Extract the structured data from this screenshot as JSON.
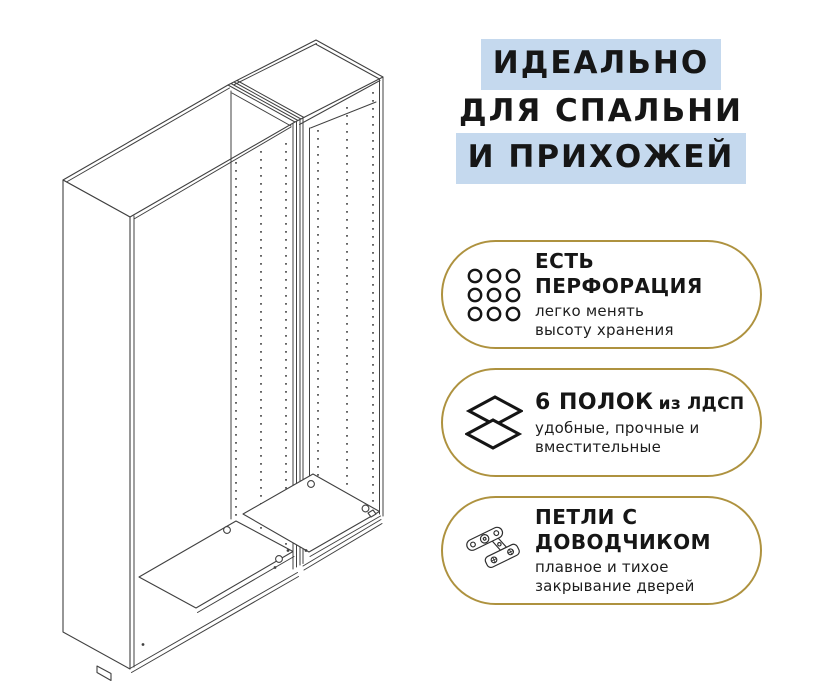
{
  "colors": {
    "highlight_blue": "#c5d9ee",
    "badge_border_gold": "#ae923f",
    "text": "#161616",
    "drawing_line": "#404040",
    "background": "#ffffff"
  },
  "heading": {
    "lines": [
      {
        "text": "ИДЕАЛЬНО",
        "highlighted": true
      },
      {
        "text": "ДЛЯ СПАЛЬНИ",
        "highlighted": false
      },
      {
        "text": "И ПРИХОЖЕЙ",
        "highlighted": true
      }
    ]
  },
  "badges": [
    {
      "icon": "perforation-grid-icon",
      "title_lines": [
        "ЕСТЬ",
        "ПЕРФОРАЦИЯ"
      ],
      "subtitle_lines": [
        "легко менять",
        "высоту хранения"
      ]
    },
    {
      "icon": "shelves-layers-icon",
      "title_main": "6 ПОЛОК",
      "title_suffix": "из ЛДСП",
      "subtitle_lines": [
        "удобные, прочные и",
        "вместительные"
      ]
    },
    {
      "icon": "hinge-icon",
      "title_lines": [
        "ПЕТЛИ С",
        "ДОВОДЧИКОМ"
      ],
      "subtitle_lines": [
        "плавное и тихое",
        "закрывание дверей"
      ]
    }
  ],
  "illustration": {
    "label": "two-section wardrobe frame, isometric line drawing with shelf-pin perforation rows"
  }
}
